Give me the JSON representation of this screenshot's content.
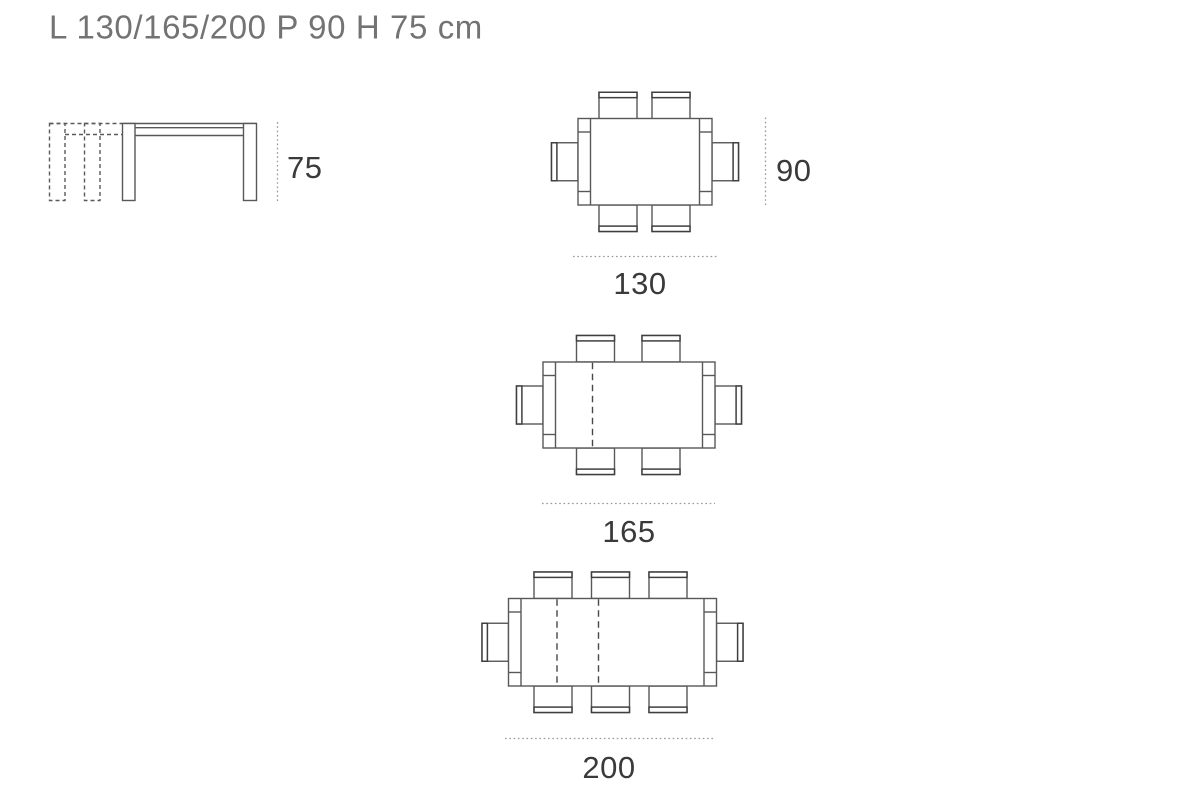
{
  "title": "L 130/165/200 P 90 H 75 cm",
  "side_view": {
    "height_label": "75",
    "extension_leaves": 2
  },
  "top_views": [
    {
      "length_label": "130",
      "depth_label": "90",
      "chairs": 6,
      "extension_split_lines": 0
    },
    {
      "length_label": "165",
      "chairs": 6,
      "extension_split_lines": 1
    },
    {
      "length_label": "200",
      "chairs": 8,
      "extension_split_lines": 2
    }
  ],
  "colors": {
    "background": "#ffffff",
    "line": "#58585a",
    "backrest_line": "#3f3f41",
    "dashed_extension_line": "#5a5a5c",
    "dotted_dimension_line": "#98989a",
    "title_text": "#737376",
    "label_text": "#3a3a3c"
  }
}
